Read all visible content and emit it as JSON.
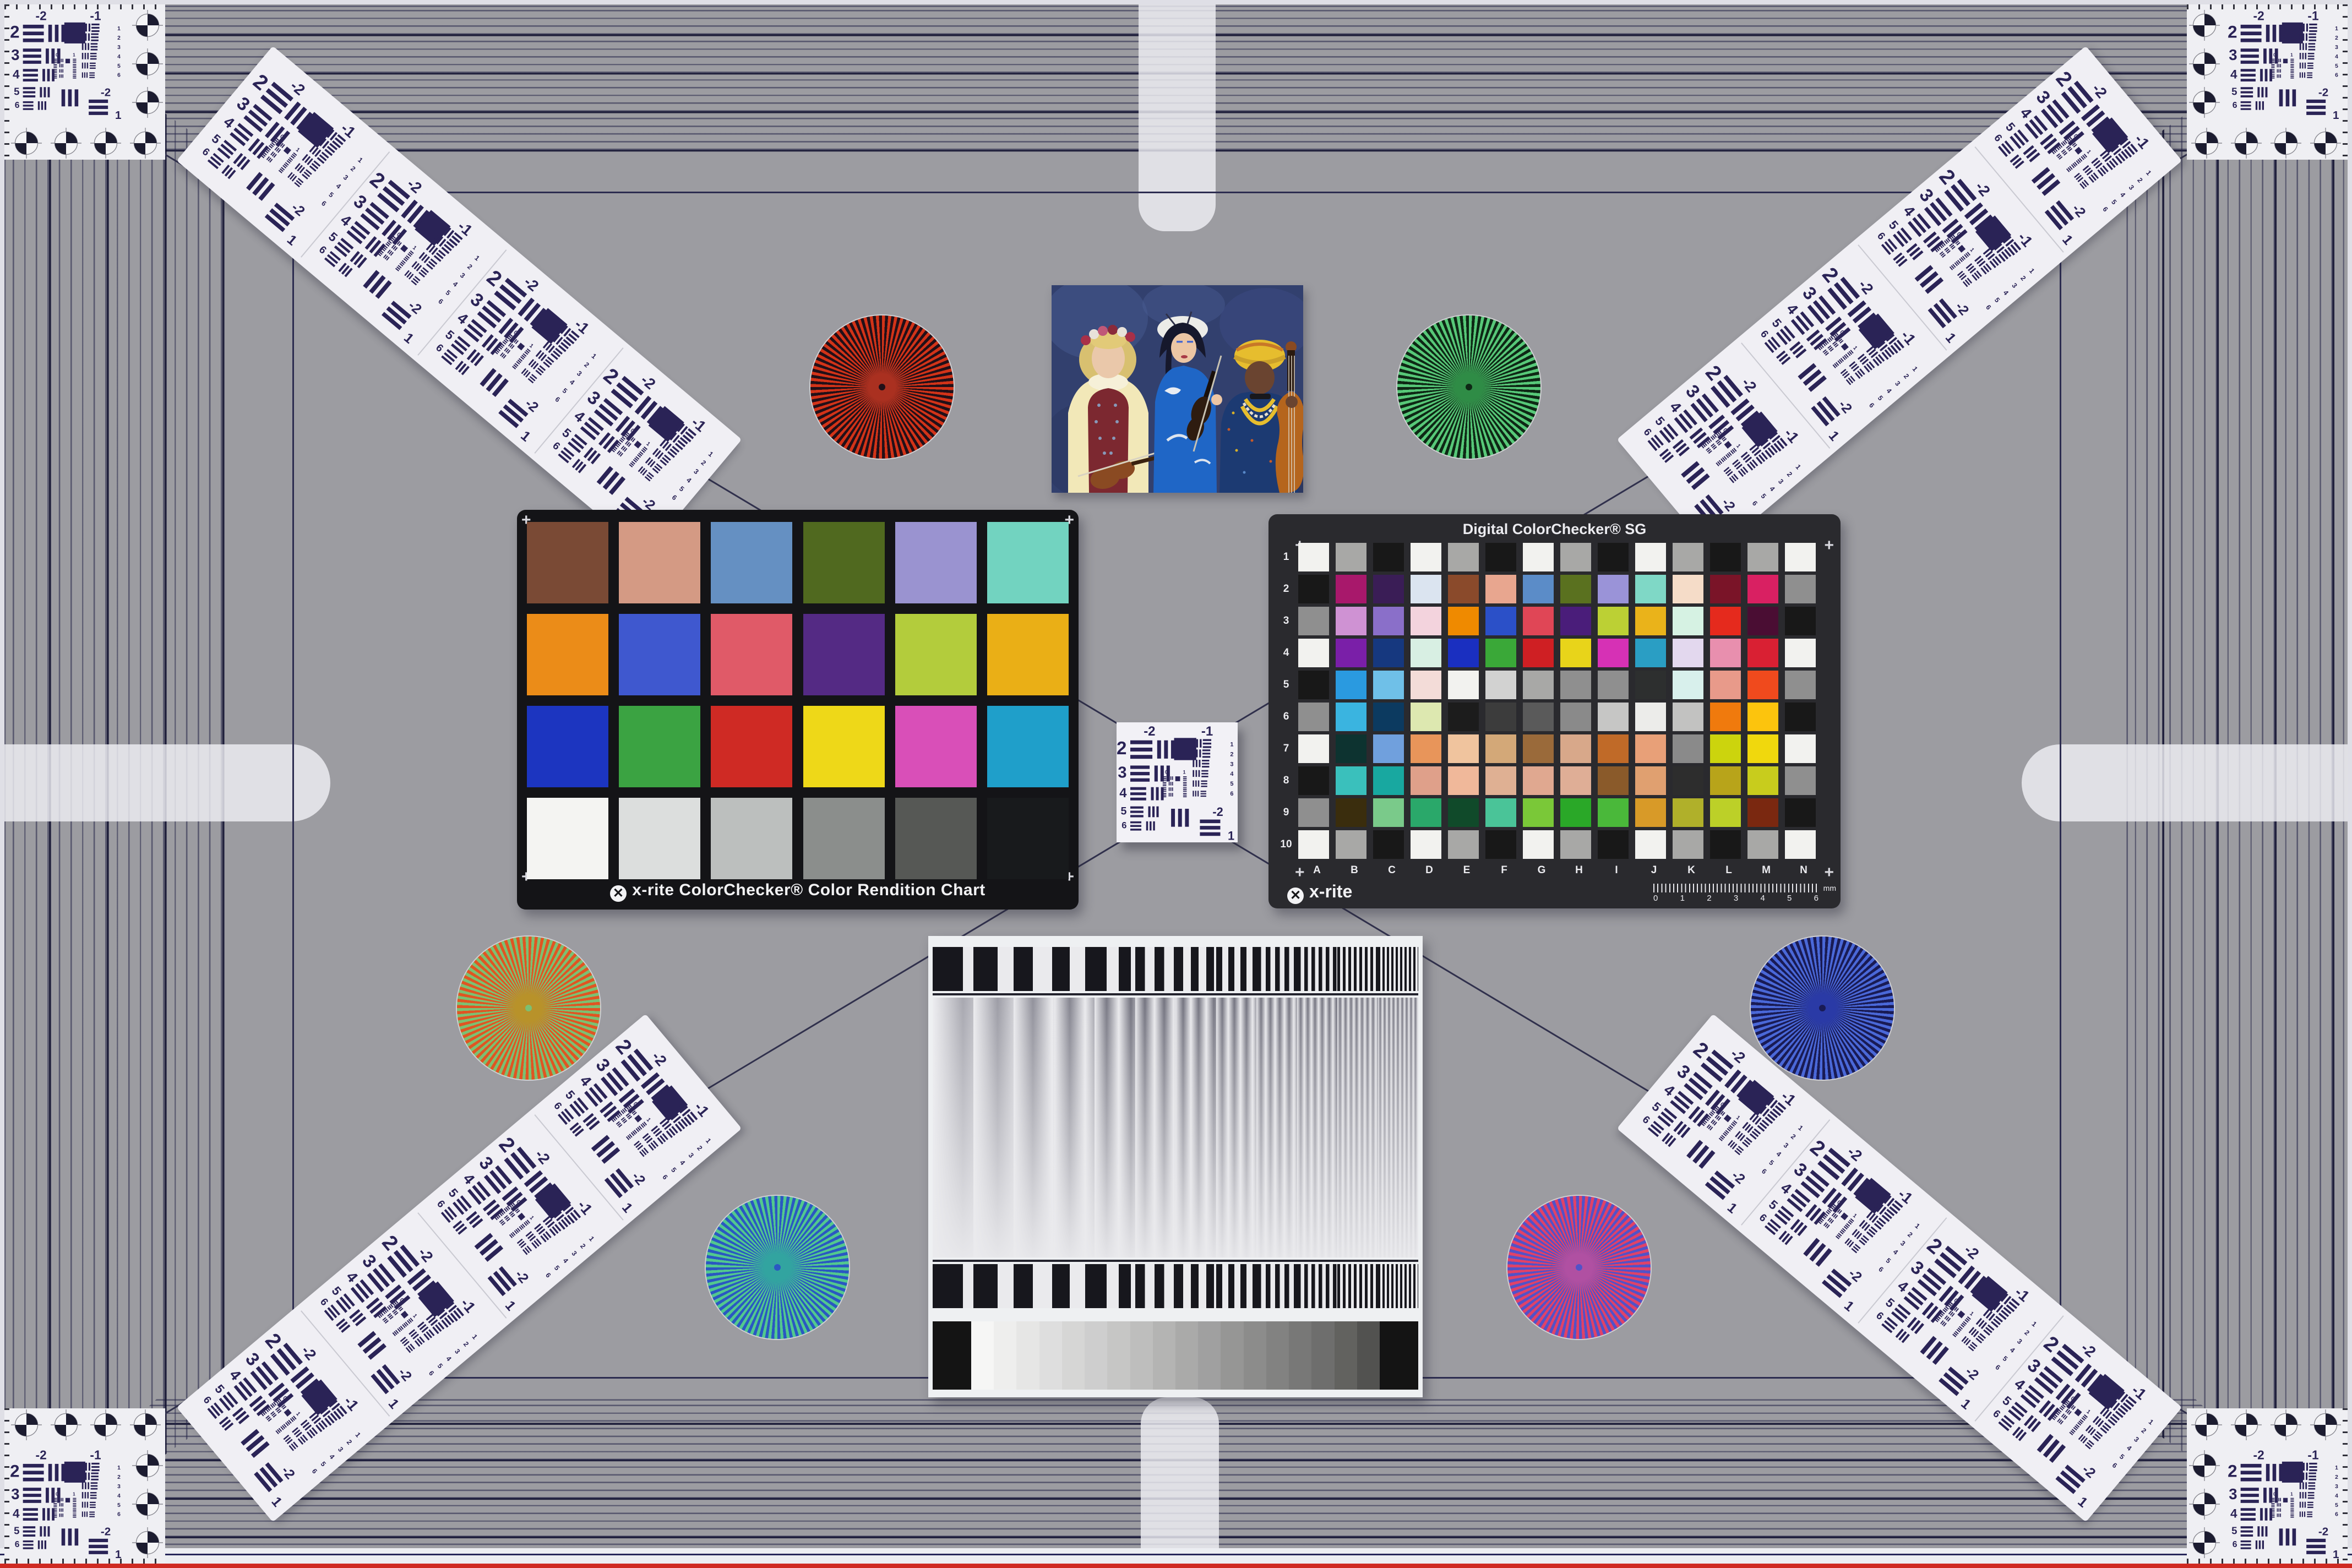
{
  "scene": {
    "background": "#9c9ca1",
    "tramline_color": "#2c2c50",
    "edge_red_line": "#cf2a22",
    "edge_navy_line": "#27275a"
  },
  "cc24": {
    "caption": "x-rite ColorChecker® Color Rendition Chart",
    "logo_glyph": "✕",
    "patches": [
      "#7a4a35",
      "#d49a84",
      "#6590c2",
      "#50691f",
      "#9a93d0",
      "#72d3c0",
      "#eb8c18",
      "#3f58cf",
      "#e05a68",
      "#542a84",
      "#b3cc3c",
      "#eaaf16",
      "#1c35c0",
      "#3ba342",
      "#cf2a24",
      "#eed818",
      "#d94fb8",
      "#1f9fca",
      "#f4f4f2",
      "#dcdedd",
      "#bcbfbe",
      "#8b8e8c",
      "#565855",
      "#181a1c"
    ]
  },
  "sg": {
    "title": "Digital ColorChecker® SG",
    "logo": "x-rite",
    "logo_glyph": "✕",
    "row_labels": [
      "1",
      "2",
      "3",
      "4",
      "5",
      "6",
      "7",
      "8",
      "9",
      "10"
    ],
    "col_labels": [
      "A",
      "B",
      "C",
      "D",
      "E",
      "F",
      "G",
      "H",
      "I",
      "J",
      "K",
      "L",
      "M",
      "N"
    ],
    "ruler_labels": [
      "0",
      "1",
      "2",
      "3",
      "4",
      "5",
      "6"
    ],
    "ruler_unit": "mm",
    "patches": [
      [
        "#f2f2ef",
        "#a8a8a6",
        "#181818",
        "#f2f2ef",
        "#a8a8a6",
        "#181818",
        "#f2f2ef",
        "#a8a8a6",
        "#181818",
        "#f2f2ef",
        "#a8a8a6",
        "#181818",
        "#a8a8a6",
        "#f2f2ef"
      ],
      [
        "#181818",
        "#a8186b",
        "#3a1d56",
        "#dbe4f0",
        "#8a4a2b",
        "#e8a68f",
        "#5b8cc8",
        "#5a711f",
        "#9a93d8",
        "#7fd8c6",
        "#f5dcc8",
        "#7a1428",
        "#d92062",
        "#8f8f8f"
      ],
      [
        "#8f8f8f",
        "#cf92d3",
        "#8a6fc9",
        "#f3d3dd",
        "#ef8a00",
        "#2b50c8",
        "#e04656",
        "#4a1d7a",
        "#bcd034",
        "#eab31a",
        "#d6f2e3",
        "#e52a1d",
        "#4a0d33",
        "#181818"
      ],
      [
        "#f2f2ef",
        "#7a1fa8",
        "#16387f",
        "#d8efe3",
        "#1a2fc0",
        "#3aa838",
        "#cf1f23",
        "#e8d41a",
        "#d631b5",
        "#2a9ec4",
        "#e3d8ee",
        "#e88fae",
        "#d92033",
        "#f2f2ef"
      ],
      [
        "#181818",
        "#2a9ae0",
        "#6fc0e8",
        "#f3dcd8",
        "#f2f2ef",
        "#d2d2d1",
        "#a8a8a6",
        "#8f8f8f",
        "#8f8f8f",
        "#2d2f2f",
        "#d8f0ec",
        "#e89a8a",
        "#f04a1d",
        "#8f8f8f"
      ],
      [
        "#8f8f8f",
        "#3ab4e0",
        "#0c3a60",
        "#dde8b0",
        "#1c1c1c",
        "#3c3c3c",
        "#5a5a5a",
        "#8a8a8a",
        "#c6c6c5",
        "#ececea",
        "#c2c2c1",
        "#f07a0d",
        "#fcc40d",
        "#181818"
      ],
      [
        "#f2f2ef",
        "#0d3330",
        "#70a0dd",
        "#e8955a",
        "#f0c49e",
        "#d3a878",
        "#9a6a3a",
        "#d8a88a",
        "#c06a28",
        "#e8a078",
        "#8a8a8a",
        "#ccd40d",
        "#f0d80d",
        "#f2f2ef"
      ],
      [
        "#181818",
        "#3ac0bc",
        "#18a8a0",
        "#dfa08a",
        "#f0b89a",
        "#dfb093",
        "#e0a890",
        "#dfae96",
        "#8a5a2a",
        "#e0a070",
        "#2d2d2d",
        "#b8a41a",
        "#c8cc1d",
        "#8f8f8f"
      ],
      [
        "#8f8f8f",
        "#3a2d0d",
        "#7aca8a",
        "#2aa86a",
        "#104a2a",
        "#4ac498",
        "#7ac838",
        "#2aa828",
        "#4ab83a",
        "#d89a28",
        "#b0b02a",
        "#bcd028",
        "#7a2810",
        "#181818"
      ],
      [
        "#f2f2ef",
        "#a8a8a6",
        "#181818",
        "#f2f2ef",
        "#a8a8a6",
        "#181818",
        "#f2f2ef",
        "#a8a8a6",
        "#181818",
        "#f2f2ef",
        "#a8a8a6",
        "#181818",
        "#a8a8a6",
        "#f2f2ef"
      ]
    ]
  },
  "usaf": {
    "top_labels": [
      "-2",
      "-1"
    ],
    "left_labels": [
      "2",
      "3",
      "4",
      "5",
      "6"
    ],
    "right_labels": [
      "1",
      "2",
      "3",
      "4",
      "5",
      "6"
    ],
    "bottom_labels": [
      "-2",
      "1"
    ],
    "inner_labels": [
      "0",
      "1"
    ]
  },
  "stars": [
    {
      "name": "red-black-star",
      "c1": "#d23318",
      "c2": "#221018",
      "center": "#aa3020"
    },
    {
      "name": "green-black-star",
      "c1": "#57c878",
      "c2": "#0e2815",
      "center": "#2f8c46"
    },
    {
      "name": "orange-green-star",
      "c1": "#e05522",
      "c2": "#7cc072",
      "center": "#b8922a"
    },
    {
      "name": "blue-navy-star",
      "c1": "#4a68d8",
      "c2": "#191b55",
      "center": "#2a3aa6"
    },
    {
      "name": "green-blue-star",
      "c1": "#52c88e",
      "c2": "#2a58c2",
      "center": "#32a4a0"
    },
    {
      "name": "red-blue-star",
      "c1": "#e04268",
      "c2": "#5252c8",
      "center": "#b050a2"
    }
  ],
  "sweep": {
    "periods": [
      110,
      88,
      70,
      56,
      44,
      35,
      28,
      22,
      17,
      13,
      10,
      8
    ],
    "bar_color": "#17171d",
    "soft_color": "#73737f",
    "bg": "#eaeaed"
  },
  "grayscale": {
    "end_block": "#141414",
    "steps": [
      "#f6f6f5",
      "#eeeeed",
      "#e6e6e5",
      "#dedede",
      "#d6d6d5",
      "#cecece",
      "#c6c6c5",
      "#bebebd",
      "#b4b4b3",
      "#aaaaa9",
      "#a0a0a0",
      "#969695",
      "#8c8c8b",
      "#828281",
      "#787877",
      "#6e6e6d",
      "#62625f",
      "#525250"
    ]
  },
  "photo": {
    "subject": "three musicians portrait",
    "background": "#32406e"
  }
}
